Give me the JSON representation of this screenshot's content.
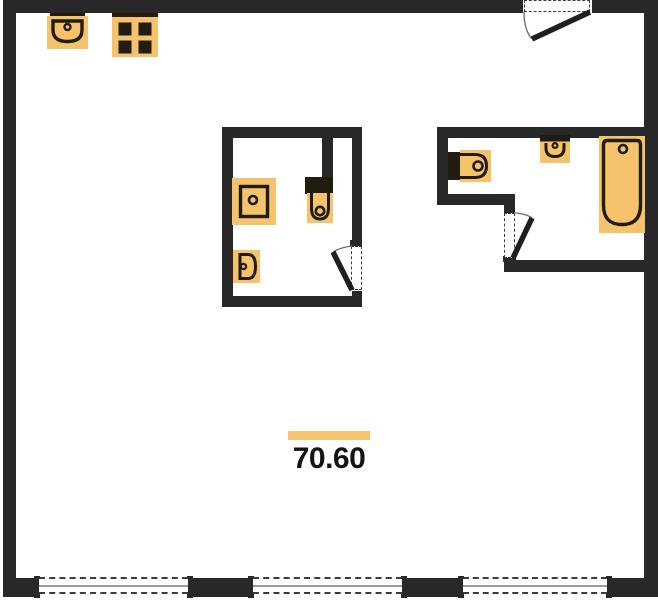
{
  "page": {
    "title": "apartment-floor-plan"
  },
  "area_label": {
    "value": "70.60"
  },
  "colors": {
    "wall": "#282828",
    "fixture-fill": "#f4c36b",
    "fixture-outline": "#221b10",
    "accent-bar": "#f6c46c",
    "window-line": "#9a9a9a",
    "dash": "#3c3c3c",
    "door-leaf": "#1f1f1f",
    "arc": "#666666",
    "text": "#141414",
    "background": "#ffffff"
  },
  "icons": {
    "kitchen_sink": "kitchen-sink-icon",
    "stove": "stove-icon",
    "entry_door": "door-swing-icon",
    "shower_tray": "shower-tray-icon",
    "main_bath_toilet": "toilet-icon",
    "main_bath_basin": "wall-basin-icon",
    "main_bath_door": "door-swing-icon",
    "second_bath_toilet": "toilet-icon",
    "second_bath_basin": "wall-basin-icon",
    "bathtub": "bathtub-icon",
    "second_bath_door": "door-swing-icon",
    "windows": "window-icon"
  }
}
